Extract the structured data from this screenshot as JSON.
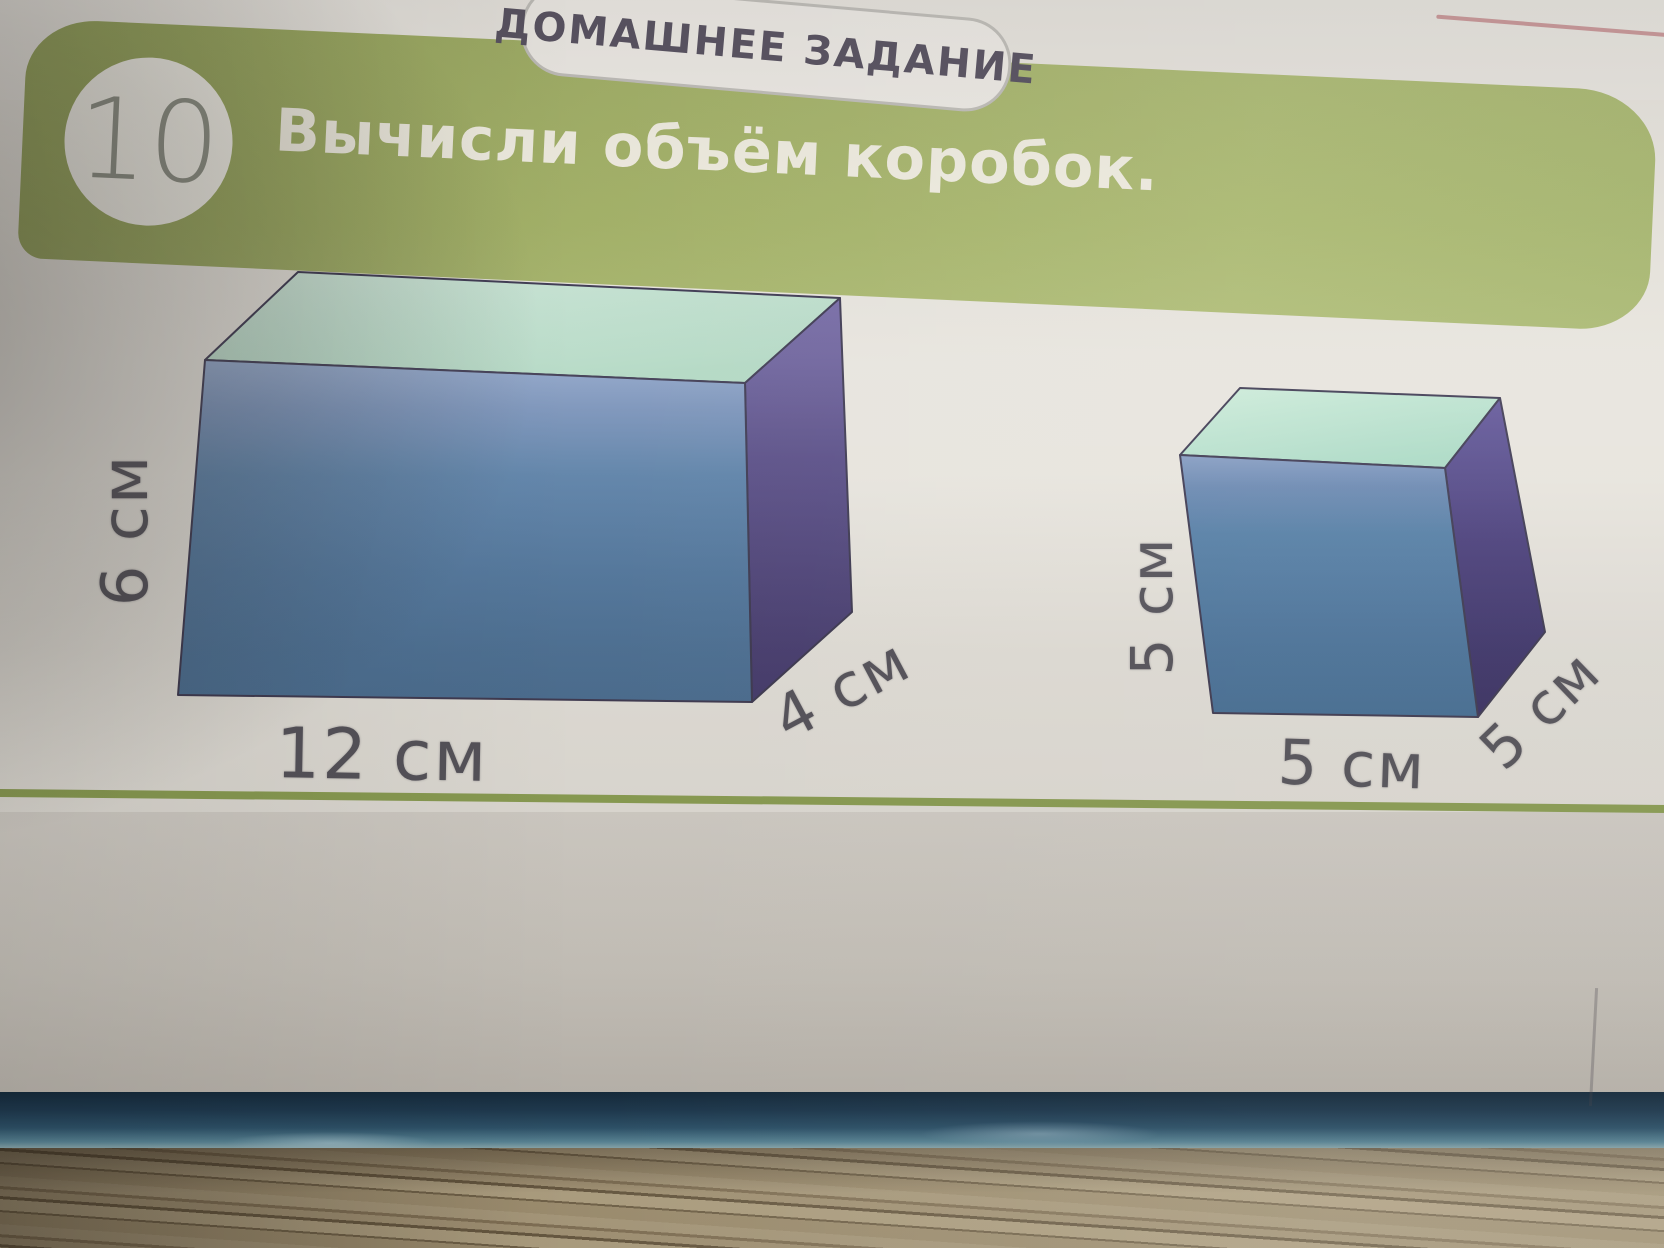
{
  "header": {
    "tab_label": "ДОМАШНЕЕ ЗАДАНИЕ",
    "task_number": "10",
    "title": "Вычисли объём коробок."
  },
  "figures": {
    "large_box": {
      "height_label": "6 см",
      "width_label": "12 см",
      "depth_label": "4 см"
    },
    "cube_box": {
      "height_label": "5 см",
      "width_label": "5 см",
      "depth_label": "5 см"
    }
  },
  "colors": {
    "band_green": "#a7b56c",
    "rule_green": "#8da153",
    "box_front_blue": "#54799f",
    "box_side_purple": "#554a80",
    "box_top_mint": "#bcdecb",
    "book_edge_blue": "#1d3e57",
    "table_wood": "#b4a383"
  }
}
